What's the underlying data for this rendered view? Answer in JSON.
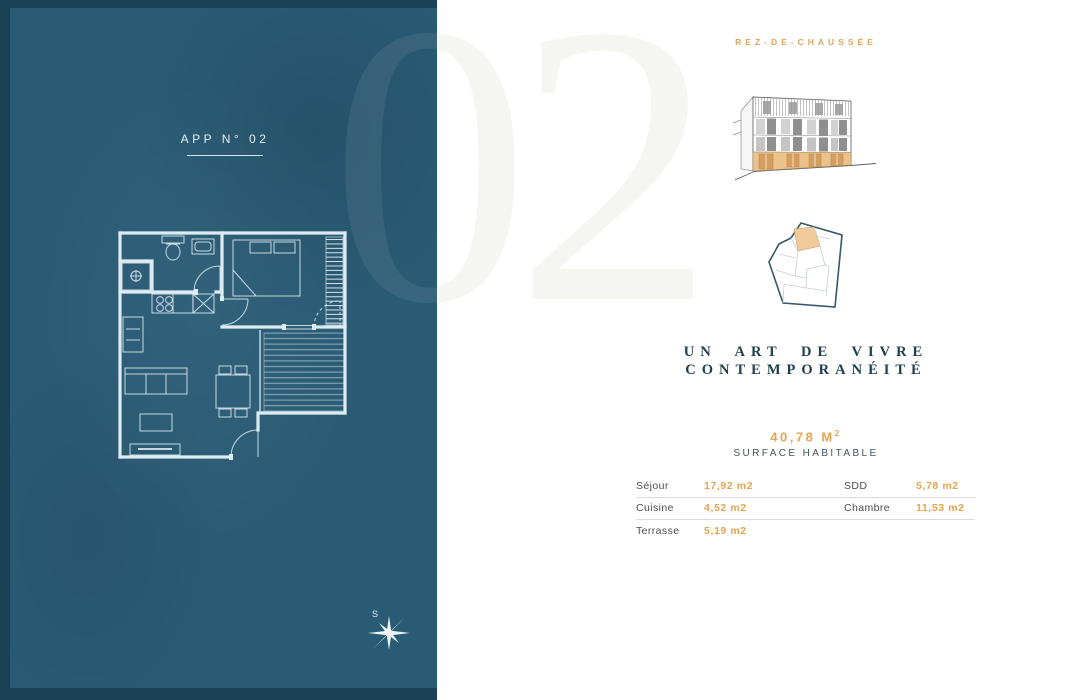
{
  "left_panel": {
    "apartment_label": "APP N° 02",
    "compass_label": "S"
  },
  "watermark": "02",
  "right_panel": {
    "floor_label": "REZ-DE-CHAUSSÉE",
    "tagline": {
      "line1": "UN ART DE VIVRE",
      "line2": "CONTEMPORANÉITÉ"
    },
    "surface": {
      "value": "40,78 M",
      "superscript": "2",
      "caption": "SURFACE HABITABLE"
    },
    "rooms": {
      "rows": [
        {
          "label_left": "Séjour",
          "value_left": "17,92 m2",
          "label_right": "SDD",
          "value_right": "5,78 m2"
        },
        {
          "label_left": "Cuisine",
          "value_left": "4,52 m2",
          "label_right": "Chambre",
          "value_right": "11,53 m2"
        },
        {
          "label_left": "Terrasse",
          "value_left": "5,19 m2",
          "label_right": "",
          "value_right": ""
        }
      ]
    }
  },
  "colors": {
    "panel_teal": "#2A5B75",
    "panel_frame": "#1B4156",
    "accent_gold": "#DCA55B",
    "value_orange": "#E5A44F",
    "deep_navy": "#21404F",
    "plan_line": "#DFEBF2"
  }
}
